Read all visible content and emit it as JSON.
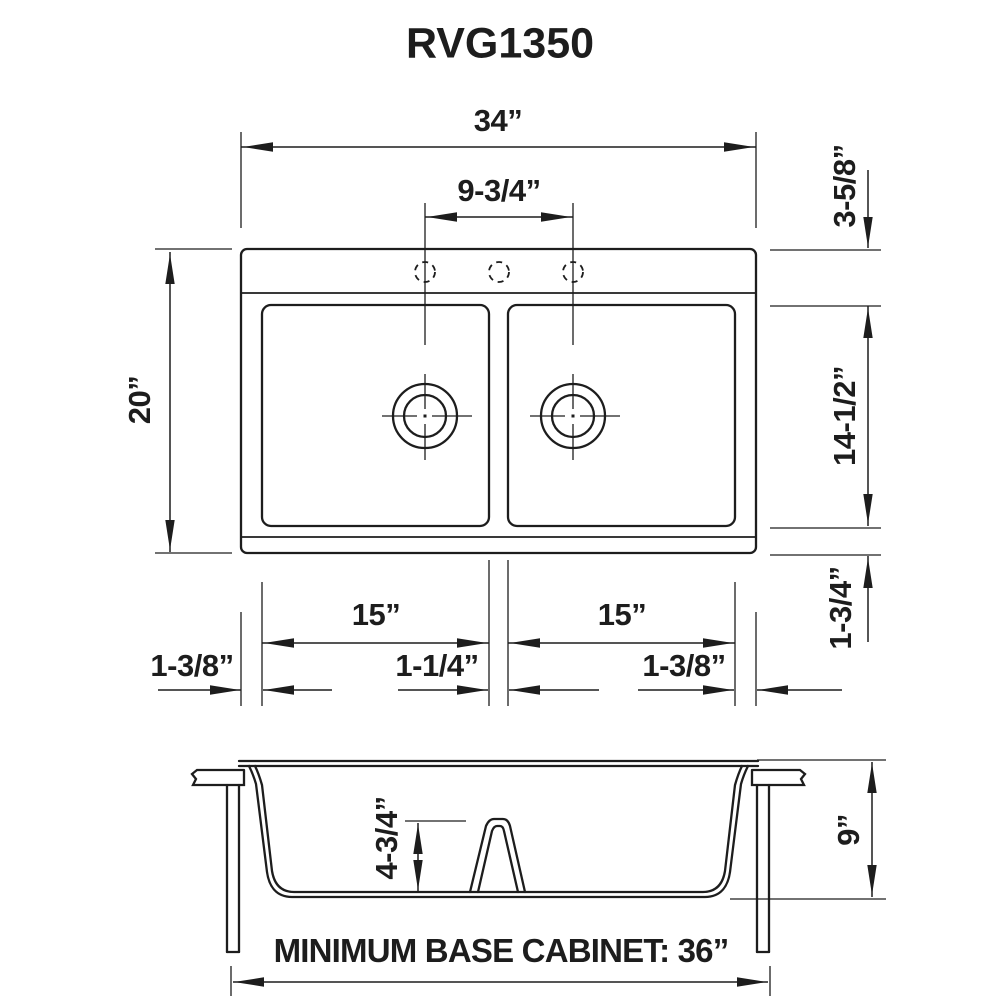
{
  "title": "RVG1350",
  "colors": {
    "ink": "#1d1d1d",
    "background": "#ffffff"
  },
  "plan_view": {
    "dims": {
      "overall_width": "34”",
      "faucet_hole_span": "9-3/4”",
      "overall_depth": "20”",
      "rear_deck": "3-5/8”",
      "bowl_front_back": "14-1/2”",
      "front_deck": "1-3/4”",
      "left_bowl_width": "15”",
      "right_bowl_width": "15”",
      "left_edge": "1-3/8”",
      "center_divider": "1-1/4”",
      "right_edge": "1-3/8”"
    }
  },
  "section_view": {
    "dims": {
      "divider_height": "4-3/4”",
      "bowl_depth": "9”"
    },
    "note": "MINIMUM BASE CABINET: 36”"
  }
}
